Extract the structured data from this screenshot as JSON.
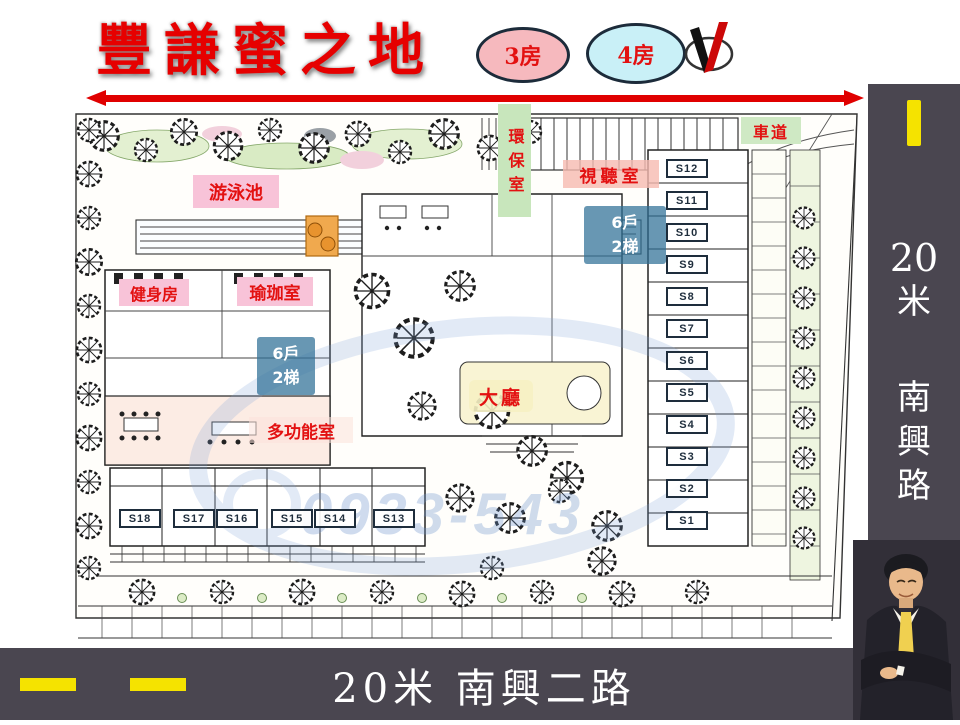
{
  "header": {
    "title": "豐謙蜜之地",
    "badge_3": "3房",
    "badge_4": "4房"
  },
  "plan": {
    "labels": {
      "pool": "游泳池",
      "eco_room": "環保室",
      "av_room": "視聽室",
      "driveway": "車道",
      "gym": "健身房",
      "yoga": "瑜珈室",
      "lobby": "大廳",
      "multipurpose": "多功能室",
      "households": "6戶",
      "elevators": "2梯"
    },
    "units_right": [
      "S12",
      "S11",
      "S10",
      "S9",
      "S8",
      "S7",
      "S6",
      "S5",
      "S4",
      "S3",
      "S2",
      "S1"
    ],
    "units_bottom": [
      "S18",
      "S17",
      "S16",
      "S15",
      "S14",
      "S13"
    ],
    "watermark": "0933-543"
  },
  "right_road": {
    "chars": [
      "20",
      "米",
      "南",
      "興",
      "路"
    ],
    "full": "20米 南興路"
  },
  "bottom_road": {
    "label": "20米 南興二路"
  },
  "colors": {
    "title_red": "#e60000",
    "badge3_bg": "#f6b9be",
    "badge4_bg": "#c9f0f7",
    "label_pink": "#f8c3d8",
    "label_green": "#cde9c3",
    "lobby_yellow": "#f6f1c3",
    "note_blue": "#2e6f96",
    "bar_dark": "#4a4650",
    "road_yellow": "#f5e300",
    "arrow_red": "#e00000"
  }
}
